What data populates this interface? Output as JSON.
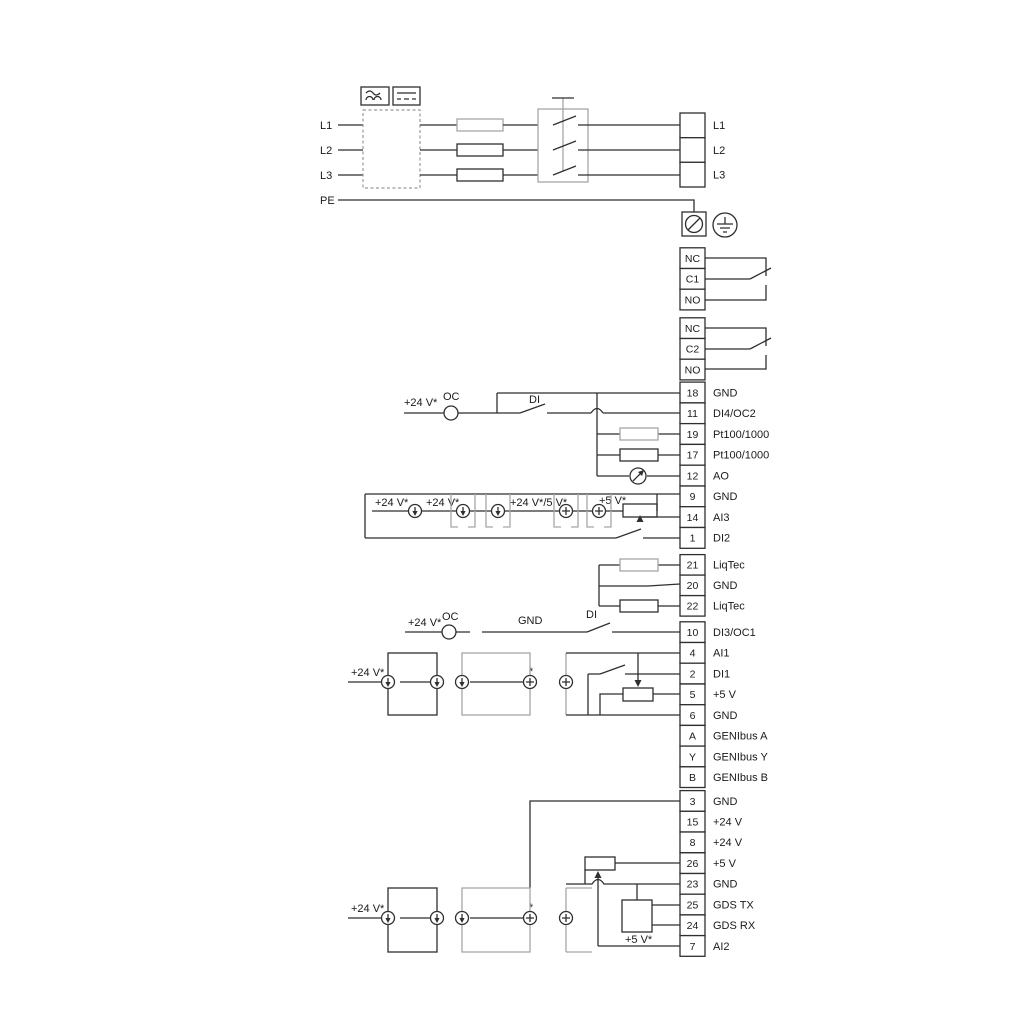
{
  "diagram_title": "Drive wiring diagram",
  "colors": {
    "line": "#2f2f2f",
    "alt_line": "#a6a6a6",
    "background": "#ffffff"
  },
  "mains": {
    "inputs": [
      "L1",
      "L2",
      "L3",
      "PE"
    ],
    "outputs": [
      "L1",
      "L2",
      "L3"
    ]
  },
  "relays": [
    {
      "cells": [
        "NC",
        "C1",
        "NO"
      ]
    },
    {
      "cells": [
        "NC",
        "C2",
        "NO"
      ]
    }
  ],
  "terminal_strips": {
    "io1": [
      {
        "num": "18",
        "label": "GND"
      },
      {
        "num": "11",
        "label": "DI4/OC2"
      },
      {
        "num": "19",
        "label": "Pt100/1000"
      },
      {
        "num": "17",
        "label": "Pt100/1000"
      },
      {
        "num": "12",
        "label": "AO"
      },
      {
        "num": "9",
        "label": "GND"
      },
      {
        "num": "14",
        "label": "AI3"
      },
      {
        "num": "1",
        "label": "DI2"
      }
    ],
    "liqtec": [
      {
        "num": "21",
        "label": "LiqTec"
      },
      {
        "num": "20",
        "label": "GND"
      },
      {
        "num": "22",
        "label": "LiqTec"
      }
    ],
    "io2": [
      {
        "num": "10",
        "label": "DI3/OC1"
      },
      {
        "num": "4",
        "label": "AI1"
      },
      {
        "num": "2",
        "label": "DI1"
      },
      {
        "num": "5",
        "label": "+5 V"
      },
      {
        "num": "6",
        "label": "GND"
      },
      {
        "num": "A",
        "label": "GENIbus A"
      },
      {
        "num": "Y",
        "label": "GENIbus Y"
      },
      {
        "num": "B",
        "label": "GENIbus B"
      }
    ],
    "io3": [
      {
        "num": "3",
        "label": "GND"
      },
      {
        "num": "15",
        "label": "+24 V"
      },
      {
        "num": "8",
        "label": "+24 V"
      },
      {
        "num": "26",
        "label": "+5 V"
      },
      {
        "num": "23",
        "label": "GND"
      },
      {
        "num": "25",
        "label": "GDS TX"
      },
      {
        "num": "24",
        "label": "GDS RX"
      },
      {
        "num": "7",
        "label": "AI2"
      }
    ]
  },
  "wire_labels": {
    "v24": "+24 V*",
    "v24_5": "+24 V*/5 V*",
    "v5": "+5 V*",
    "oc": "OC",
    "di": "DI",
    "gnd": "GND"
  }
}
